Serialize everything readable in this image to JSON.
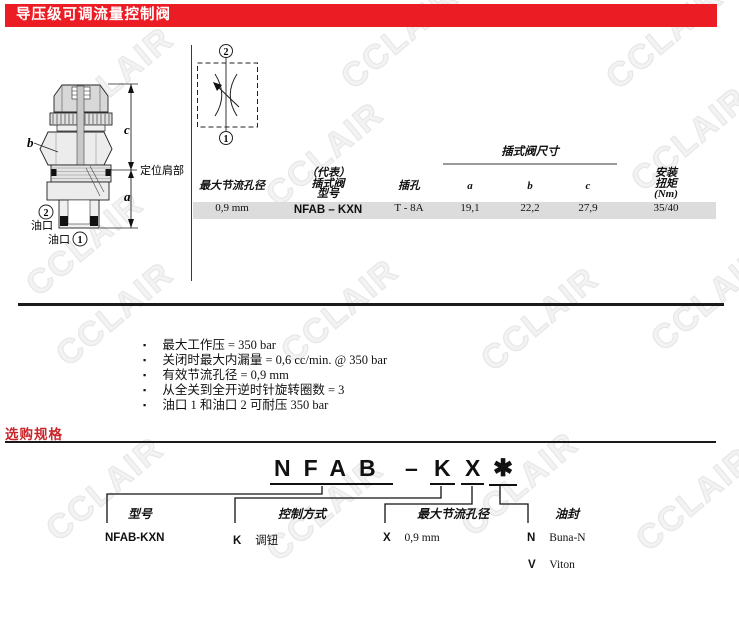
{
  "page": {
    "title": "导压级可调流量控制阀"
  },
  "colors": {
    "accent_red": "#ec1c24",
    "heading_red": "#c9252b",
    "row_gray": "#dcdcdc",
    "rule_dark": "#1a1a1a"
  },
  "watermark": "CCLAIR",
  "valve_diagram": {
    "dim_b": "b",
    "dim_c": "c",
    "dim_a": "a",
    "shoulder": "定位肩部",
    "port2_num": "2",
    "port2": "油口",
    "port1": "油口",
    "port1_num": "1"
  },
  "schematic": {
    "top_port": "2",
    "bottom_port": "1"
  },
  "spec_table": {
    "group_header": "插式阀尺寸",
    "headers": {
      "orifice": "最大节流孔径",
      "model_l1": "（代表）",
      "model_l2": "插式阀",
      "model_l3": "型号",
      "cavity": "插孔",
      "a": "a",
      "b": "b",
      "c": "c",
      "torque_l1": "安装",
      "torque_l2": "扭矩",
      "torque_l3": "(Nm)"
    },
    "row": {
      "orifice": "0,9 mm",
      "model": "NFAB – KXN",
      "cavity": "T - 8A",
      "a": "19,1",
      "b": "22,2",
      "c": "27,9",
      "torque": "35/40"
    }
  },
  "features": [
    "最大工作压 = 350 bar",
    "关闭时最大内漏量 = 0,6 cc/min. @ 350 bar",
    "有效节流孔径 = 0,9 mm",
    "从全关到全开逆时针旋转圈数 = 3",
    "油口 1 和油口 2 可耐压 350 bar"
  ],
  "ordering": {
    "section_title": "选购规格",
    "code": {
      "model": "NFAB",
      "dash": "–",
      "control": "K",
      "orifice": "X",
      "seal": "✱"
    },
    "groups": [
      {
        "label": "型号",
        "items": [
          {
            "code": "NFAB-KXN",
            "desc": ""
          }
        ]
      },
      {
        "label": "控制方式",
        "items": [
          {
            "code": "K",
            "desc": "调钮"
          }
        ]
      },
      {
        "label": "最大节流孔径",
        "items": [
          {
            "code": "X",
            "desc": "0,9 mm"
          }
        ]
      },
      {
        "label": "油封",
        "items": [
          {
            "code": "N",
            "desc": "Buna-N"
          },
          {
            "code": "V",
            "desc": "Viton"
          }
        ]
      }
    ]
  }
}
